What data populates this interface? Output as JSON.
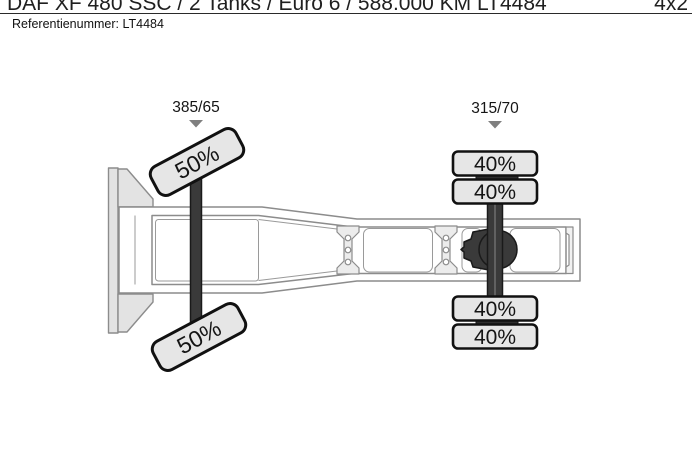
{
  "header": {
    "title": "DAF XF 480 SSC / 2 Tanks / Euro 6 / 588.000 KM LT4484",
    "drive_config": "4x2",
    "reference": "Referentienummer: LT4484"
  },
  "chassis_diagram": {
    "view": "top-view tractor chassis with tire tread condition",
    "front_axle": {
      "tire_size_label": "385/65",
      "tires": [
        {
          "position": "front-left",
          "condition": "50%"
        },
        {
          "position": "front-right",
          "condition": "50%"
        }
      ]
    },
    "rear_axle": {
      "tire_size_label": "315/70",
      "tires": [
        {
          "position": "rear-left-outer",
          "condition": "40%"
        },
        {
          "position": "rear-left-inner",
          "condition": "40%"
        },
        {
          "position": "rear-right-inner",
          "condition": "40%"
        },
        {
          "position": "rear-right-outer",
          "condition": "40%"
        }
      ]
    },
    "colors": {
      "tire_fill": "#e6e6e6",
      "axle_dark": "#3a3a3a",
      "frame_stroke": "#8c8c8c",
      "marker_gray": "#7f7f7f",
      "bracket_fill": "#ececec"
    }
  }
}
